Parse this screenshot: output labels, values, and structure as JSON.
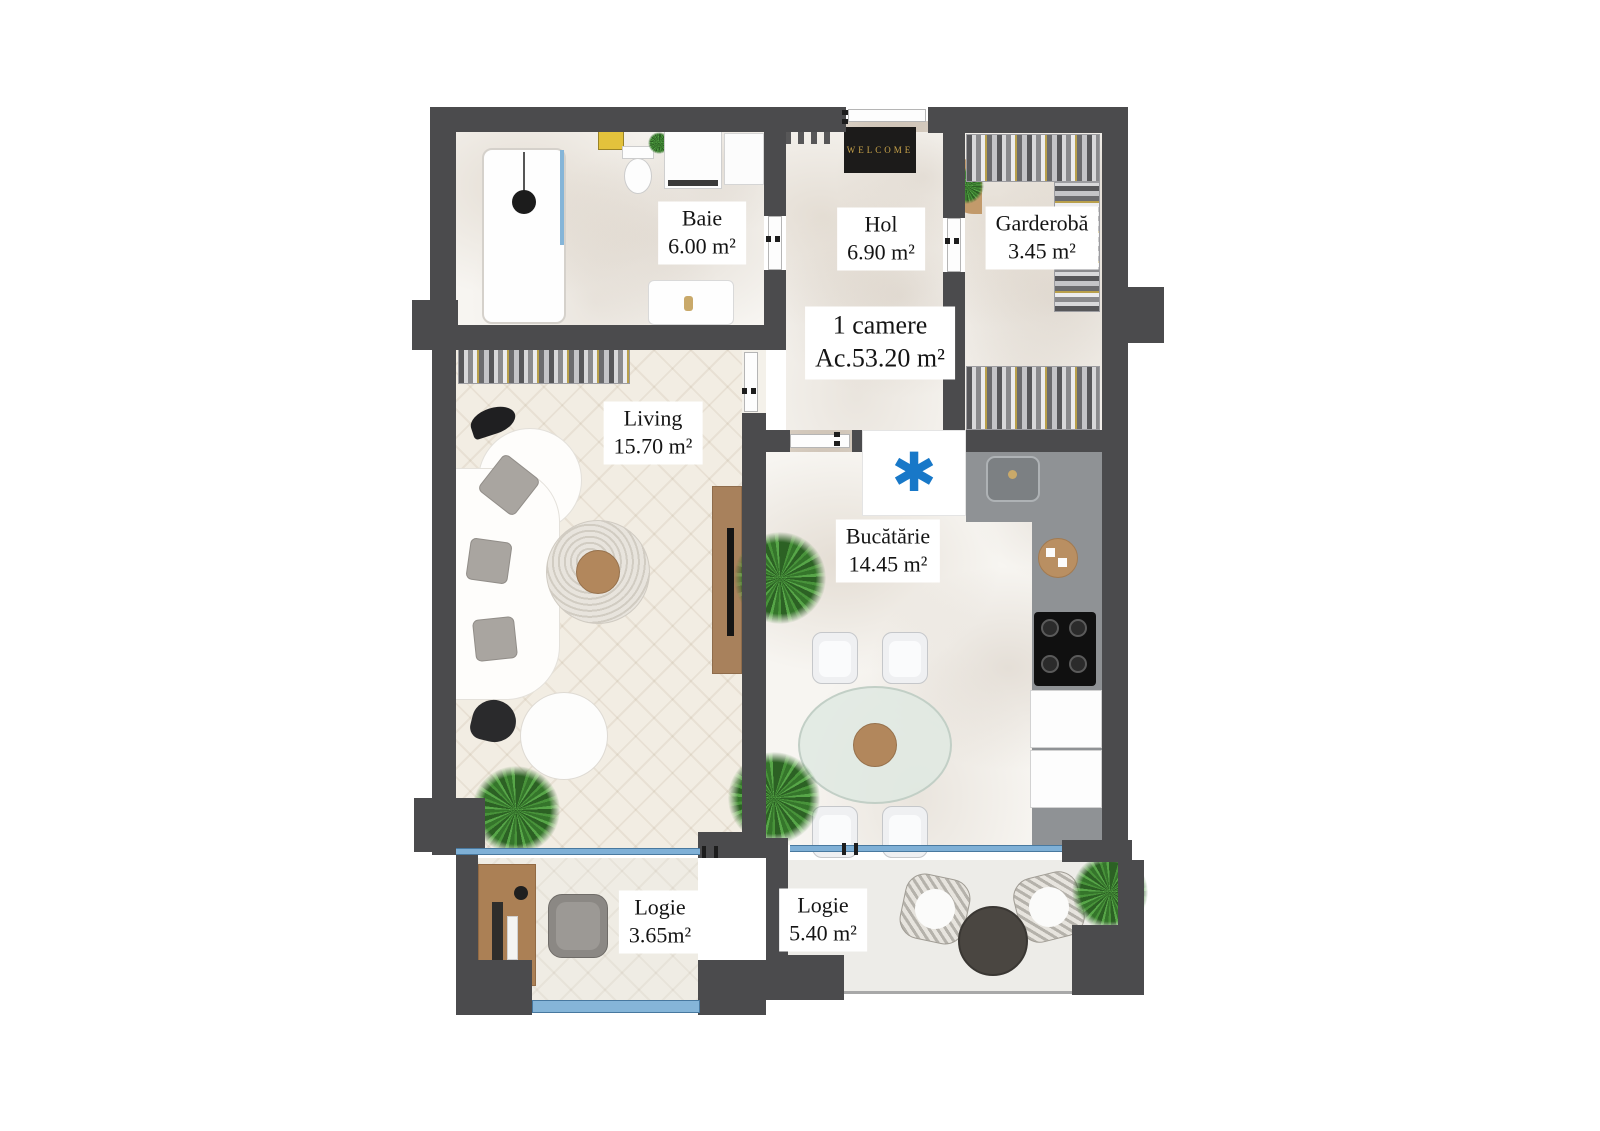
{
  "plan": {
    "unit": {
      "title": "1 camere",
      "area": "Ac.53.20 m²"
    },
    "rooms": [
      {
        "name": "Baie",
        "area": "6.00 m²"
      },
      {
        "name": "Hol",
        "area": "6.90 m²"
      },
      {
        "name": "Garderobă",
        "area": "3.45 m²"
      },
      {
        "name": "Living",
        "area": "15.70 m²"
      },
      {
        "name": "Bucătărie",
        "area": "14.45 m²"
      },
      {
        "name": "Logie",
        "area": "3.65m²"
      },
      {
        "name": "Logie",
        "area": "5.40 m²"
      }
    ],
    "entrance_mat_text": "WELCOME",
    "ac_symbol": "✱",
    "colors": {
      "wall": "#4b4b4d",
      "window_blue": "#7fb0d6",
      "ac_blue": "#1878c8",
      "mat_gold": "#c9a44a",
      "wood": "#ab815b",
      "plant_green": "#48933a",
      "counter_gray": "#8f9295"
    }
  }
}
